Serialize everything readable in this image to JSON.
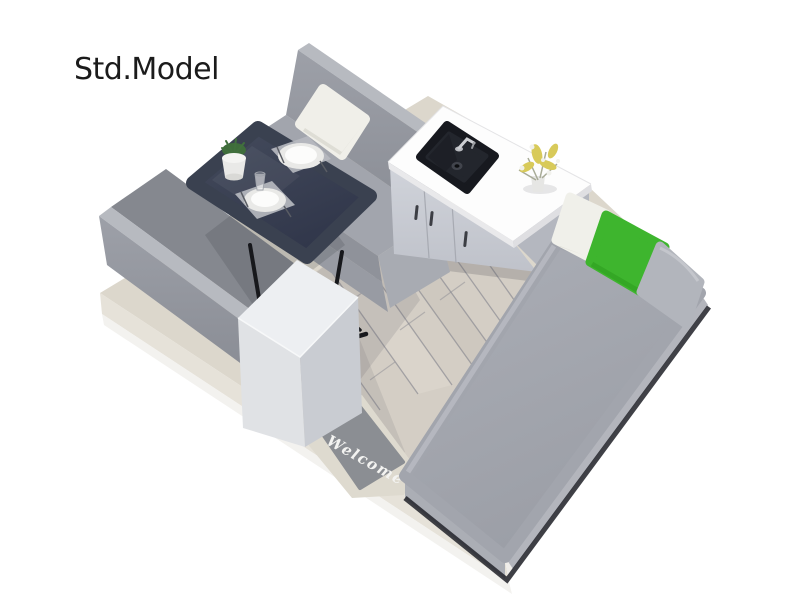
{
  "scene": {
    "title": "Std.Model",
    "doormat_text": "Welcome"
  },
  "palette": {
    "background": "#ffffff",
    "upholstery_gray": "#9b9ea6",
    "mattress_gray": "#a2a5ad",
    "accent_green_pillow": "#3eb52e",
    "white_pillow": "#f0f0ea",
    "table_navy": "#3a4150",
    "wood_floor": "#d4cec5",
    "platform_beige": "#dcd7cc",
    "counter_top_white": "#fdfdfd",
    "cabinet_gray": "#c9ccd4",
    "sink_black": "#17191f",
    "doormat_gray": "#8b8e93"
  },
  "objects": [
    "dinette-bench-upper",
    "dinette-bench-lower",
    "dining-table",
    "place-settings",
    "potted-plant",
    "drinking-glass",
    "kitchen-cabinet",
    "kitchen-sink",
    "faucet",
    "flower-vase",
    "storage-cube",
    "bed",
    "white-pillow",
    "green-pillow",
    "gray-pillow",
    "welcome-doormat",
    "wood-floor",
    "platform-base"
  ]
}
